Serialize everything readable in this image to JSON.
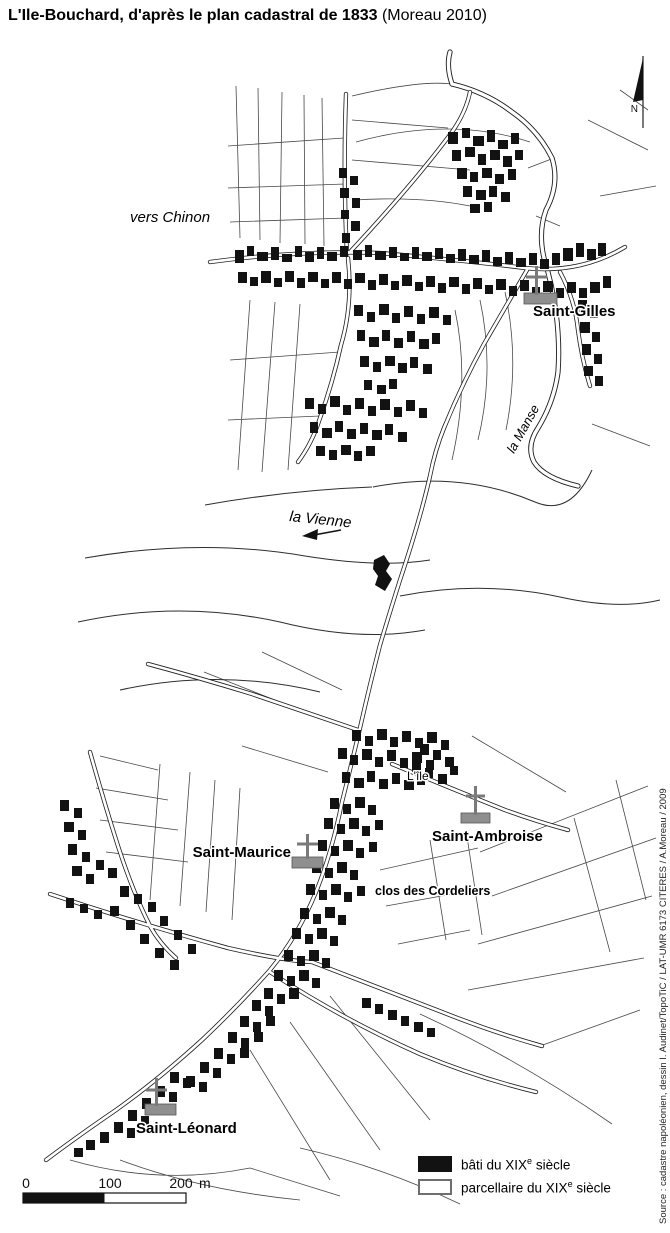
{
  "title": {
    "main": "L'Ile-Bouchard, d'après le plan cadastral de 1833",
    "suffix": " (Moreau 2010)"
  },
  "map": {
    "north_label": "N",
    "labels": {
      "vers_chinon": "vers Chinon",
      "la_manse": "la Manse",
      "la_vienne": "la Vienne",
      "l_ile": "L'île",
      "saint_gilles": "Saint-Gilles",
      "saint_ambroise": "Saint-Ambroise",
      "saint_maurice": "Saint-Maurice",
      "clos_des_cordeliers": "clos des Cordeliers",
      "saint_leonard": "Saint-Léonard"
    }
  },
  "scale_bar": {
    "t0": "0",
    "t100": "100",
    "t200": "200",
    "unit": "m"
  },
  "legend": {
    "items": [
      {
        "pre": "bâti du XIX",
        "sup": "e",
        "post": " siècle"
      },
      {
        "pre": "parcellaire du XIX",
        "sup": "e",
        "post": " siècle"
      }
    ]
  },
  "source_note": "Source : cadastre napoléonien, dessin I. Audinet/TopoTiC / LAT-UMR 6173 CITERES / A.Moreau / 2009",
  "colors": {
    "building": "#121212",
    "parcel_line": "#474747",
    "road_line": "#1b1b1b",
    "church_marker_fill": "#8f8f8f",
    "text": "#000000"
  }
}
